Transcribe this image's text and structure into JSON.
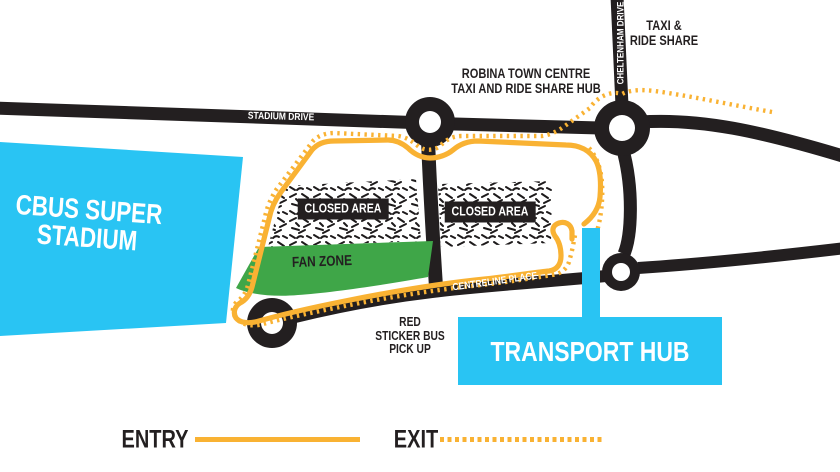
{
  "title": "Cbus Super Stadium transport map",
  "colors": {
    "cyan": "#29C4F3",
    "green": "#3FA648",
    "yellow": "#F9B233",
    "black": "#231F20",
    "white": "#FFFFFF"
  },
  "stadium": {
    "line1": "CBUS SUPER",
    "line2": "STADIUM"
  },
  "roads": {
    "stadium_drive": "STADIUM DRIVE",
    "cheltenham_drive": "CHELTENHAM DRIVE",
    "centreline_place": "CENTRELINE PLACE"
  },
  "areas": {
    "closed_left": "CLOSED AREA",
    "closed_right": "CLOSED AREA",
    "fan_zone": "FAN ZONE",
    "transport_hub": "TRANSPORT HUB"
  },
  "annotations": {
    "taxi_ride_share": {
      "line1": "TAXI &",
      "line2": "RIDE SHARE"
    },
    "robina_hub": {
      "line1": "ROBINA TOWN CENTRE",
      "line2": "TAXI AND RIDE SHARE HUB"
    },
    "red_sticker": {
      "line1": "RED",
      "line2": "STICKER BUS",
      "line3": "PICK UP"
    }
  },
  "legend": {
    "entry": "ENTRY",
    "exit": "EXIT"
  }
}
